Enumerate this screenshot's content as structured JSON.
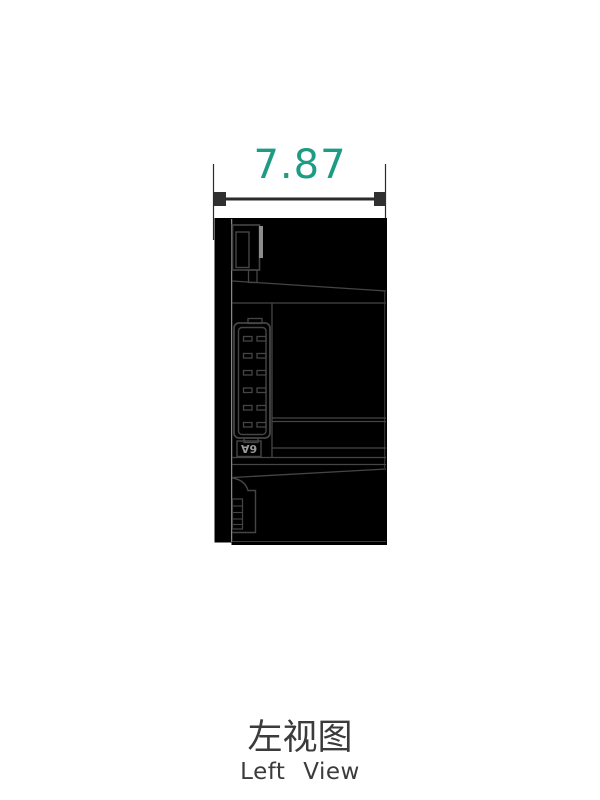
{
  "dimension": {
    "value": "7.87",
    "color": "#1e9b83"
  },
  "device": {
    "connector_label": "6A"
  },
  "caption": {
    "zh": "左视图",
    "en": "Left View"
  },
  "colors": {
    "body_fill": "#000000",
    "detail_line": "#454545",
    "tab_gray": "#8c8c8c",
    "separation_line": "#a8a8a8",
    "dimension_line": "#2b2b2b",
    "caption_text": "#3b3b3b"
  }
}
